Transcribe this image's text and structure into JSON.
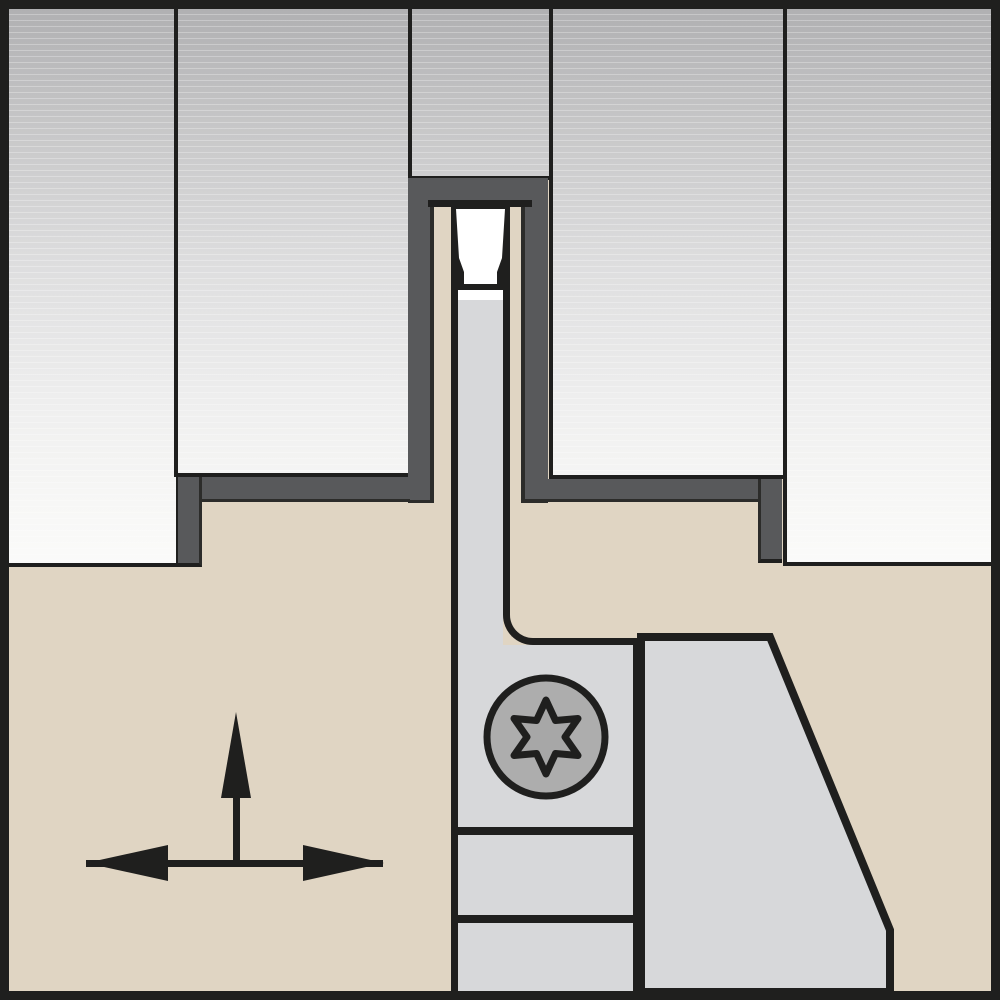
{
  "diagram": {
    "title": "Grooving / parting tool holder with insert - sectional technical illustration",
    "type": "technical-illustration",
    "text_labels": [],
    "parts": {
      "workpiece": "sectioned workpiece shown as five gradient panels",
      "cut_edge": "charcoal machined-groove edge band",
      "tool_body": "tan tool holder body",
      "insert": "white grooving insert seated in slot",
      "support_blade": "gray support blade under insert",
      "clamp_block": "gray clamp block with chamfered corner",
      "clamp_screw": "Torx-head clamp screw",
      "arrows": "feed-direction indicator (up arrow + left-right double arrow)"
    },
    "arrows": {
      "vertical_label": "upward feed direction",
      "horizontal_label": "lateral feed direction"
    }
  },
  "colors": {
    "black": "#1f1f1e",
    "dark_edge": "#2c2c2a",
    "charcoal": "#58595b",
    "tan": "#e0d5c3",
    "light_gray": "#d7d8da",
    "insert_white": "#ffffff",
    "screw_gray": "#adadad",
    "star_gray": "#a7a7a7",
    "panel_top": "#b0b0b2",
    "panel_bottom": "#fbfbfa"
  }
}
